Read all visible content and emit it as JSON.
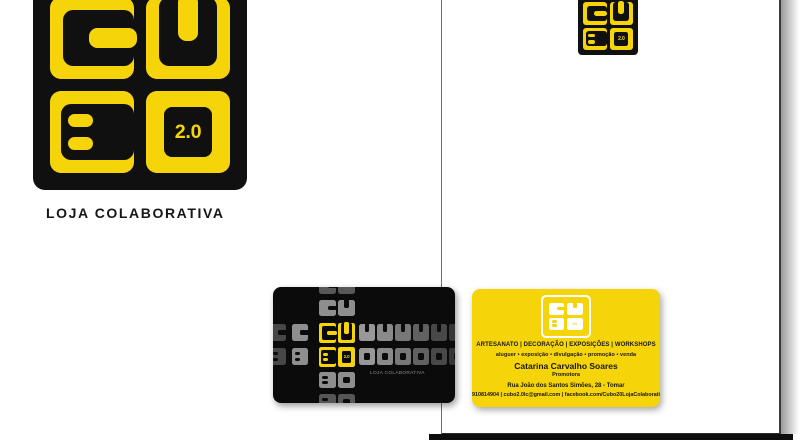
{
  "brand": {
    "letters": [
      "C",
      "U",
      "B"
    ],
    "version": "2.0",
    "tagline": "LOJA COLABORATIVA"
  },
  "colors": {
    "yellow": "#F6D40A",
    "logo_black": "#101010",
    "card_black_bg": "#0B0B0B",
    "white": "#FFFFFF",
    "gray_tagline": "#8D8D8D",
    "text_dark": "#161616"
  },
  "main_logo": {
    "tiles": [
      "C",
      "U",
      "B",
      "2.0"
    ]
  },
  "letterhead_logo": {
    "tiles": [
      "C",
      "U",
      "B",
      "2.0"
    ]
  },
  "card_black": {
    "tagline": "LOJA COLABORATIVA",
    "center_tiles": [
      {
        "letter": "C",
        "x": 46,
        "y": 36,
        "w": 17,
        "h": 20
      },
      {
        "letter": "U",
        "x": 65,
        "y": 36,
        "w": 17,
        "h": 20
      },
      {
        "letter": "B",
        "x": 46,
        "y": 60,
        "w": 17,
        "h": 20
      },
      {
        "letter": "2.0",
        "x": 65,
        "y": 60,
        "w": 17,
        "h": 20
      }
    ],
    "pattern_tiles": [
      {
        "letter": "C",
        "x": 46,
        "y": -9,
        "w": 17,
        "h": 16,
        "color": "#585858"
      },
      {
        "letter": "U",
        "x": 65,
        "y": -9,
        "w": 17,
        "h": 16,
        "color": "#585858"
      },
      {
        "letter": "C",
        "x": 46,
        "y": 13,
        "w": 17,
        "h": 16,
        "color": "#8E8E8E"
      },
      {
        "letter": "U",
        "x": 65,
        "y": 13,
        "w": 17,
        "h": 16,
        "color": "#8E8E8E"
      },
      {
        "letter": "B",
        "x": 46,
        "y": 85,
        "w": 17,
        "h": 16,
        "color": "#8E8E8E"
      },
      {
        "letter": "O",
        "x": 65,
        "y": 85,
        "w": 17,
        "h": 16,
        "color": "#8E8E8E"
      },
      {
        "letter": "B",
        "x": 46,
        "y": 107,
        "w": 17,
        "h": 16,
        "color": "#565656"
      },
      {
        "letter": "O",
        "x": 65,
        "y": 107,
        "w": 17,
        "h": 16,
        "color": "#565656"
      },
      {
        "letter": "C",
        "x": -3,
        "y": 37,
        "w": 16,
        "h": 17,
        "color": "#474747"
      },
      {
        "letter": "C",
        "x": 19,
        "y": 37,
        "w": 16,
        "h": 17,
        "color": "#8E8E8E"
      },
      {
        "letter": "U",
        "x": 86,
        "y": 37,
        "w": 16,
        "h": 17,
        "color": "#989898"
      },
      {
        "letter": "U",
        "x": 104,
        "y": 37,
        "w": 16,
        "h": 17,
        "color": "#8A8A8A"
      },
      {
        "letter": "U",
        "x": 122,
        "y": 37,
        "w": 16,
        "h": 17,
        "color": "#787878"
      },
      {
        "letter": "U",
        "x": 140,
        "y": 37,
        "w": 16,
        "h": 17,
        "color": "#616161"
      },
      {
        "letter": "U",
        "x": 158,
        "y": 37,
        "w": 16,
        "h": 17,
        "color": "#484848"
      },
      {
        "letter": "U",
        "x": 176,
        "y": 37,
        "w": 16,
        "h": 17,
        "color": "#353535"
      },
      {
        "letter": "B",
        "x": -3,
        "y": 61,
        "w": 16,
        "h": 17,
        "color": "#474747"
      },
      {
        "letter": "B",
        "x": 19,
        "y": 61,
        "w": 16,
        "h": 17,
        "color": "#8E8E8E"
      },
      {
        "letter": "O",
        "x": 86,
        "y": 61,
        "w": 16,
        "h": 17,
        "color": "#989898"
      },
      {
        "letter": "O",
        "x": 104,
        "y": 61,
        "w": 16,
        "h": 17,
        "color": "#8A8A8A"
      },
      {
        "letter": "O",
        "x": 122,
        "y": 61,
        "w": 16,
        "h": 17,
        "color": "#787878"
      },
      {
        "letter": "O",
        "x": 140,
        "y": 61,
        "w": 16,
        "h": 17,
        "color": "#616161"
      },
      {
        "letter": "O",
        "x": 158,
        "y": 61,
        "w": 16,
        "h": 17,
        "color": "#484848"
      },
      {
        "letter": "O",
        "x": 176,
        "y": 61,
        "w": 16,
        "h": 17,
        "color": "#353535"
      }
    ]
  },
  "card_yellow": {
    "logo_tiles": [
      "C",
      "U",
      "B",
      "2.0"
    ],
    "categories": "ARTESANATO | DECORAÇÃO | EXPOSIÇÕES | WORKSHOPS",
    "services": "aluguer • exposição • divulgação • promoção • venda",
    "contact_name": "Catarina Carvalho Soares",
    "contact_role": "Promotora",
    "address": "Rua João dos Santos Simões, 28 - Tomar",
    "contacts_line": "910814904 | cubo2.0lc@gmail.com | facebook.com/Cubo20LojaColaborativa"
  }
}
